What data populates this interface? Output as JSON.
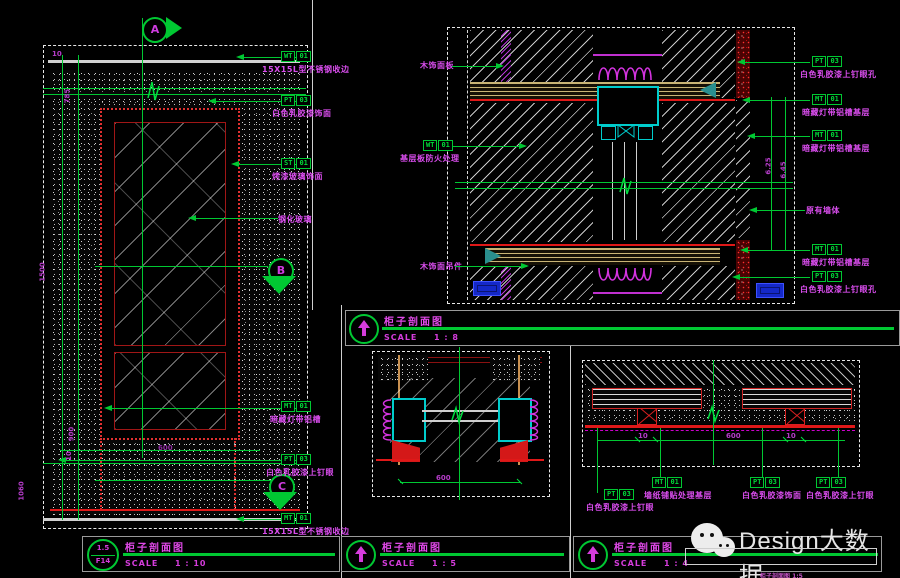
{
  "brand": {
    "name": "Design大数据"
  },
  "markers": {
    "a": "A",
    "b": "B",
    "c": "C"
  },
  "bars": {
    "tr": {
      "title": "柜子剖面图",
      "scale_prefix": "SCALE",
      "scale": "1 : 8"
    },
    "bl": {
      "ref1": "1.5",
      "ref2": "F14",
      "title": "柜子剖面图",
      "scale_prefix": "SCALE",
      "scale": "1 : 10"
    },
    "bm": {
      "title": "柜子剖面图",
      "scale_prefix": "SCALE",
      "scale": "1 : 5"
    },
    "br": {
      "title": "柜子剖面图",
      "scale_prefix": "SCALE",
      "scale": "1 : 4"
    }
  },
  "lp": {
    "tags": [
      {
        "code": "WT",
        "num": "01",
        "label": "15X15L型不锈钢收边"
      },
      {
        "code": "PT",
        "num": "03",
        "label": "白色乳胶漆饰面"
      },
      {
        "code": "ST",
        "num": "01",
        "label": "烤漆玻璃饰面"
      },
      {
        "code": "MT",
        "num": "01",
        "label": "暗藏灯带铝槽"
      },
      {
        "code": "PT",
        "num": "03",
        "label": "白色乳胶漆上钉眼"
      },
      {
        "code": "MT",
        "num": "01",
        "label": "15X15L型不锈钢收边"
      }
    ],
    "notes": {
      "glass": "钢化玻璃"
    },
    "dims": {
      "v1": "785",
      "v2": "1500",
      "v3": "900",
      "v4": "10",
      "v5": "1060",
      "h1": "600",
      "s1": "10"
    }
  },
  "tp": {
    "left_notes": {
      "n1": "木饰面板",
      "n2": "木饰面吊件"
    },
    "left_tag": {
      "code": "WT",
      "num": "01",
      "label": "基层板防火处理"
    },
    "tags": [
      {
        "code": "PT",
        "num": "03",
        "label": "白色乳胶漆上钉眼孔"
      },
      {
        "code": "MT",
        "num": "01",
        "label": "暗藏灯带铝槽基层"
      },
      {
        "code": "MT",
        "num": "01",
        "label": "暗藏灯带铝槽基层"
      },
      {
        "code": "MT",
        "num": "01",
        "label": "暗藏灯带铝槽基层"
      },
      {
        "code": "PT",
        "num": "03",
        "label": "白色乳胶漆上钉眼孔"
      }
    ],
    "notes": {
      "wall": "原有墙体"
    },
    "dims": {
      "v1": "6.25",
      "v2": "6.45"
    }
  },
  "bm": {
    "dims": {
      "h1": "600"
    }
  },
  "br": {
    "tags": [
      {
        "code": "PT",
        "num": "03",
        "label": "白色乳胶漆上钉眼"
      },
      {
        "code": "MT",
        "num": "01",
        "label": "墙纸铺贴处理基层"
      },
      {
        "code": "PT",
        "num": "03",
        "label": "白色乳胶漆饰面"
      },
      {
        "code": "PT",
        "num": "03",
        "label": "白色乳胶漆上钉眼"
      }
    ],
    "dims": {
      "d1": "10",
      "d2": "600",
      "d3": "10"
    }
  },
  "footnote": "柜子剖面图 1:5"
}
